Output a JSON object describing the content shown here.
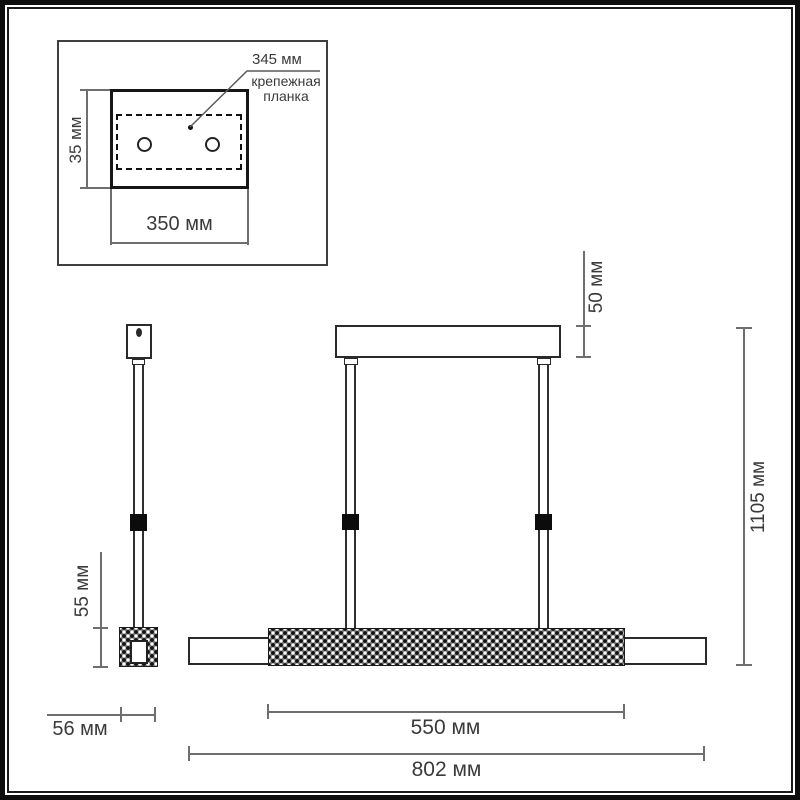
{
  "colors": {
    "object_line": "#2a2a2a",
    "dimension_line": "#6f6f6f",
    "text": "#3a3a3a",
    "crystal_fill": "#7d7d7d",
    "frame": "#0d0d0d"
  },
  "drawing": {
    "inset": {
      "plate_length_label": "345 мм",
      "plate_name": "крепежная планка",
      "plate_height_label": "35 мм",
      "canopy_width_label": "350 мм"
    },
    "front_view": {
      "canopy_height_label": "50 мм",
      "overall_height_label": "1105 мм",
      "crystal_section_label": "550 мм",
      "overall_length_label": "802 мм"
    },
    "side_view": {
      "body_height_label": "55 мм",
      "body_width_label": "56 мм"
    }
  }
}
